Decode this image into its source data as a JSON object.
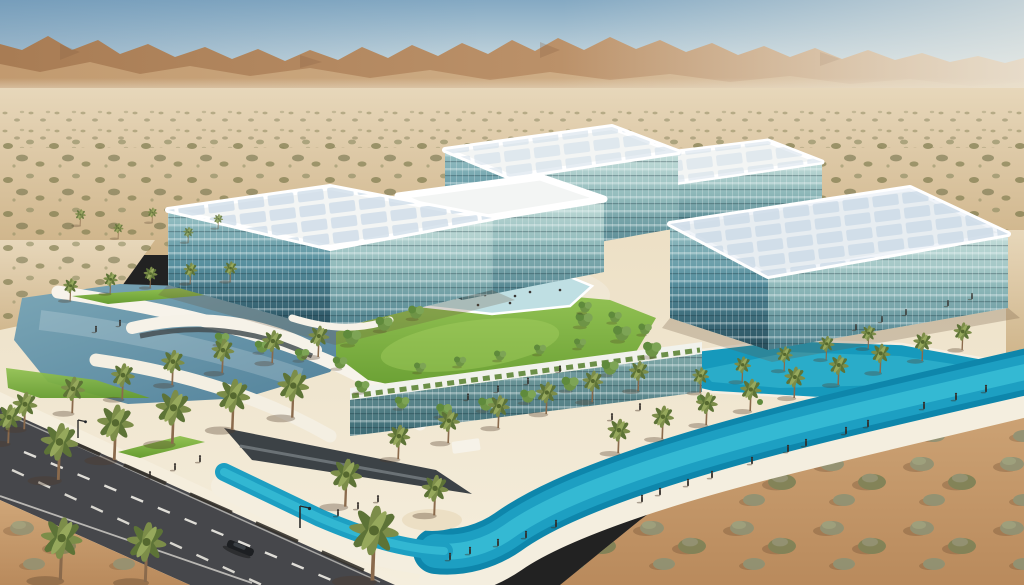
{
  "scene": {
    "type": "architectural-aerial-render",
    "aria_label": "Aerial rendering of a modern glass office campus in a desert: four large glass buildings with white solar rooftops, a central lawn courtyard with a shallow pool, turquoise canals and a lagoon lined with palm trees and pedestrian promenades, an access road in the lower left, shrub-dotted desert plain and arid mountain range on the hazy horizon",
    "environment": [
      "hazy desert sky",
      "arid mountain range",
      "shrub-dotted desert plain",
      "glass office campus",
      "white panel rooftops",
      "central lawn courtyard",
      "shallow courtyard pool",
      "turquoise canal",
      "lagoon pool",
      "steel-blue pond",
      "palm-lined promenades",
      "access road with lane markings",
      "pedestrians",
      "single car"
    ]
  },
  "palette": {
    "sky_top": "#84a9c3",
    "sky_mid": "#c2d4dc",
    "sky_horizon": "#e9ebe4",
    "mountain_dark": "#a87c54",
    "mountain_mid": "#bb9169",
    "mountain_light": "#d9bf9d",
    "mountain_shadow": "#8a6244",
    "haze": "#ece2cc",
    "desert_far": "#e7d7ba",
    "desert_mid": "#ceb388",
    "sand_warm": "#cfa678",
    "sand_warm_deep": "#b98a5c",
    "plaza_sand": "#ecdfc4",
    "walkway_light": "#f5eedd",
    "shrub_olive": "#7f7c4f",
    "shrub_sage": "#8e8c63",
    "shrub_dark": "#666741",
    "sage_big": "#8e9173",
    "lawn_light": "#93c254",
    "lawn_dark": "#679d31",
    "pool_pale": "#bfdfe3",
    "canal": "#1d9fc2",
    "canal_bright": "#38bdd6",
    "canal_deep": "#0e86ab",
    "lagoon": "#1699bc",
    "lagoon_bright": "#2fb0cc",
    "pond": "#7ba6b6",
    "pond_deep": "#51819a",
    "glass_top_l": "#9cc4c6",
    "glass_mid_l": "#58909f",
    "glass_deep_l": "#274e5c",
    "glass_top_r": "#c6dfdb",
    "glass_mid_r": "#8fb9ba",
    "glass_deep_r": "#497c89",
    "podium_top": "#7fa8a8",
    "podium_deep": "#3c6a74",
    "roof_white": "#f3f5f4",
    "roof_panel": "#c9d9e6",
    "fascia": "#ffffff",
    "road": "#46474b",
    "lane_mark": "#e9e7df",
    "palm_frond": "#7c8d49",
    "palm_frond_dark": "#5d7337",
    "palm_frond_light": "#96a85c",
    "palm_trunk": "#8a6a4c",
    "tree_green": "#6e9446",
    "tree_green_light": "#7da455",
    "tree_green_dark": "#5f8a3c",
    "person": "#332e2a",
    "car": "#1d1f22",
    "shadow": "rgba(80,58,38,0.33)"
  }
}
